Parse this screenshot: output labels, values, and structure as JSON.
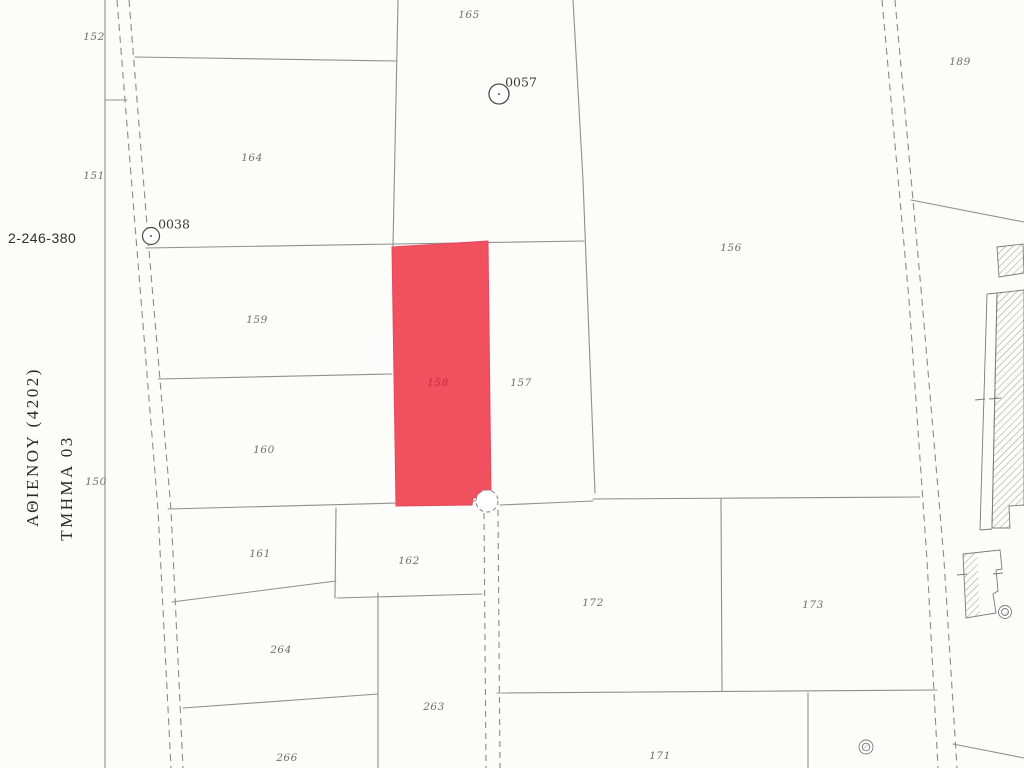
{
  "map_meta": {
    "registration_number": "2-246-380",
    "area_title": "ΑΘΙΕΝΟΥ  (4202)",
    "section_title": "ΤΜΗΜΑ  03",
    "highlighted_parcel": "158",
    "highlight_color": "#f1505e",
    "line_color": "#8f8f8f"
  },
  "markers": {
    "m0038": "0038",
    "m0057": "0057"
  },
  "parcels": {
    "150": "150",
    "151": "151",
    "152": "152",
    "156": "156",
    "157": "157",
    "158": "158",
    "159": "159",
    "160": "160",
    "161": "161",
    "162": "162",
    "164": "164",
    "165": "165",
    "171": "171",
    "172": "172",
    "173": "173",
    "189": "189",
    "263": "263",
    "264": "264",
    "266": "266"
  },
  "icons": {
    "well": "well-icon",
    "survey_point": "survey-marker-icon",
    "building": "hatched-building"
  }
}
